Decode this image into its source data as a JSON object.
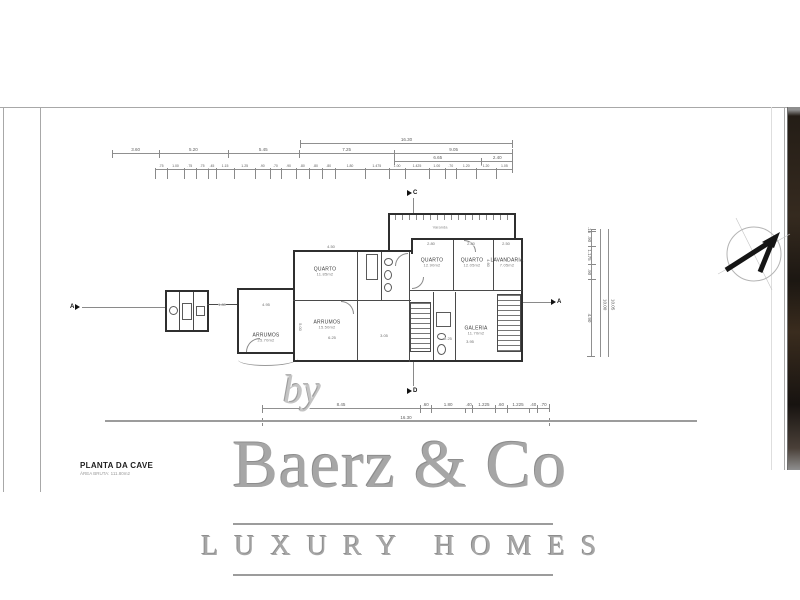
{
  "sheet": {
    "title": "PLANTA DA CAVE",
    "subtitle": "ÁREA BRUTA: 111.80m2"
  },
  "watermark": {
    "by": "by",
    "brand": "Baerz & Co",
    "tagline": "LUXURY HOMES"
  },
  "colors": {
    "wall_line": "#2f2f2f",
    "dimension_line": "#909090",
    "watermark_gray": "#a6a6a6",
    "photo_edge_dark": "#241d16"
  },
  "plan": {
    "rooms": [
      {
        "name": "QUARTO",
        "area": "11.85m2"
      },
      {
        "name": "QUARTO",
        "area": "12.90m2"
      },
      {
        "name": "QUARTO",
        "area": "12.05m2"
      },
      {
        "name": "LAVANDARIA",
        "area": "7.05m2"
      },
      {
        "name": "ARRUMOS",
        "area": "15.50m2"
      },
      {
        "name": "ARRUMOS",
        "area": "25.70m2"
      },
      {
        "name": "GALERIA",
        "area": "11.70m2"
      }
    ],
    "annotations": [
      "Varanda"
    ],
    "markers": [
      "C",
      "D",
      "A",
      "A"
    ],
    "interior_dims": [
      "4.50",
      "2.80",
      "2.80",
      "2.50",
      "4.95",
      "1.80",
      "5.00",
      "6.25",
      "3.05",
      "2.25",
      "3.95",
      "4.60"
    ]
  },
  "dimensions": {
    "top_total": "16.30",
    "top_row": [
      "3.60",
      "5.20",
      "5.45",
      "7.25",
      "9.05"
    ],
    "top_sub": [
      "6.65",
      "2.40"
    ],
    "top_detail": [
      ".75",
      "1.00",
      ".75",
      ".75",
      ".45",
      "1.15",
      "1.25",
      ".90",
      ".70",
      ".90",
      ".80",
      ".80",
      ".80",
      "1.80",
      "1.475",
      "1.00",
      "1.425",
      "1.00",
      ".70",
      "1.20",
      "1.20",
      "1.05"
    ],
    "bottom_row": [
      "8.45",
      ".60",
      "1.80",
      ".40",
      "1.225",
      ".60",
      "1.225",
      ".40",
      ".70"
    ],
    "bottom_total": "16.30",
    "right_row": [
      ".15",
      ".90",
      "1.175",
      ".90",
      "4.90"
    ],
    "right_totals": [
      "10.00",
      "10.05"
    ]
  }
}
